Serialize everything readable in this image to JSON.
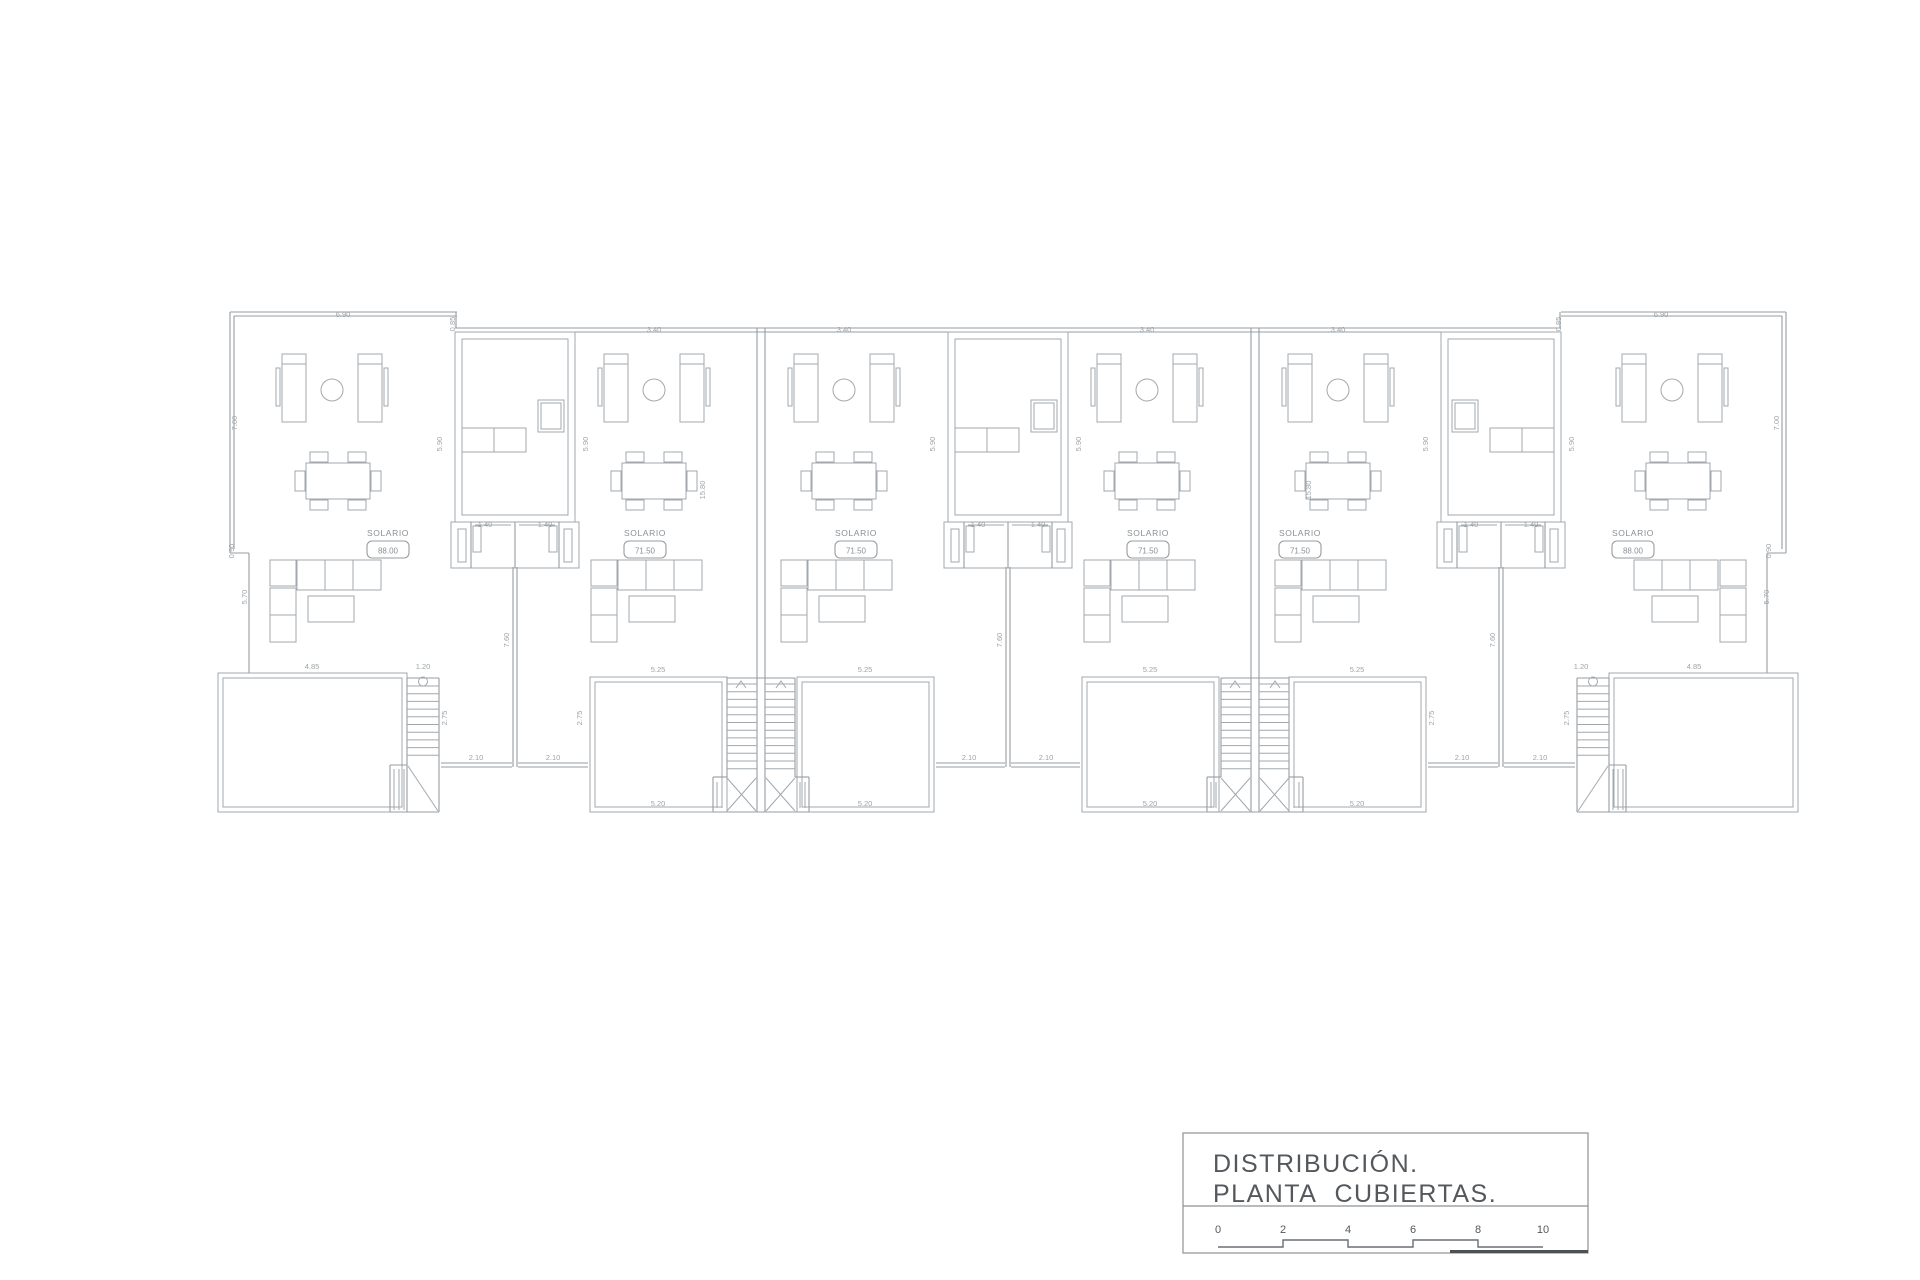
{
  "document": {
    "background": "#ffffff",
    "line_color": "#979da2",
    "furniture_line_color": "#a2a8ad",
    "dimension_text_color": "#9ea4a8",
    "title_text_color": "#54585c"
  },
  "title_block": {
    "line1": "DISTRIBUCIÓN.",
    "line2": "PLANTA CUBIERTAS.",
    "scale_numbers": [
      "0",
      "2",
      "4",
      "6",
      "8",
      "10"
    ]
  },
  "units": [
    {
      "label": "SOLARIO",
      "area": "88.00",
      "x": 388,
      "y": 536
    },
    {
      "label": "SOLARIO",
      "area": "71.50",
      "x": 645,
      "y": 536
    },
    {
      "label": "SOLARIO",
      "area": "71.50",
      "x": 856,
      "y": 536
    },
    {
      "label": "SOLARIO",
      "area": "71.50",
      "x": 1148,
      "y": 536
    },
    {
      "label": "SOLARIO",
      "area": "71.50",
      "x": 1300,
      "y": 536
    },
    {
      "label": "SOLARIO",
      "area": "88.00",
      "x": 1633,
      "y": 536
    }
  ],
  "dimensions": [
    {
      "t": "6.90",
      "x": 343,
      "y": 317,
      "r": 0
    },
    {
      "t": "6.90",
      "x": 1661,
      "y": 317,
      "r": 0
    },
    {
      "t": "3.40",
      "x": 654,
      "y": 332,
      "r": 0
    },
    {
      "t": "3.40",
      "x": 844,
      "y": 332,
      "r": 0
    },
    {
      "t": "3.40",
      "x": 1147,
      "y": 332,
      "r": 0
    },
    {
      "t": "3.40",
      "x": 1338,
      "y": 332,
      "r": 0
    },
    {
      "t": "0.85",
      "x": 455,
      "y": 324,
      "r": 1
    },
    {
      "t": "0.85",
      "x": 1561,
      "y": 324,
      "r": 1
    },
    {
      "t": "7.00",
      "x": 237,
      "y": 423,
      "r": 1
    },
    {
      "t": "7.00",
      "x": 1779,
      "y": 423,
      "r": 1
    },
    {
      "t": "5.90",
      "x": 442,
      "y": 444,
      "r": 1
    },
    {
      "t": "5.90",
      "x": 588,
      "y": 444,
      "r": 1
    },
    {
      "t": "5.90",
      "x": 935,
      "y": 444,
      "r": 1
    },
    {
      "t": "5.90",
      "x": 1081,
      "y": 444,
      "r": 1
    },
    {
      "t": "5.90",
      "x": 1428,
      "y": 444,
      "r": 1
    },
    {
      "t": "5.90",
      "x": 1574,
      "y": 444,
      "r": 1
    },
    {
      "t": "1.40",
      "x": 485,
      "y": 527,
      "r": 0
    },
    {
      "t": "1.40",
      "x": 545,
      "y": 527,
      "r": 0
    },
    {
      "t": "1.40",
      "x": 978,
      "y": 527,
      "r": 0
    },
    {
      "t": "1.40",
      "x": 1038,
      "y": 527,
      "r": 0
    },
    {
      "t": "1.40",
      "x": 1471,
      "y": 527,
      "r": 0
    },
    {
      "t": "1.40",
      "x": 1531,
      "y": 527,
      "r": 0
    },
    {
      "t": "0.90",
      "x": 234,
      "y": 551,
      "r": 1
    },
    {
      "t": "0.90",
      "x": 1771,
      "y": 551,
      "r": 1
    },
    {
      "t": "5.70",
      "x": 247,
      "y": 597,
      "r": 1
    },
    {
      "t": "5.70",
      "x": 1769,
      "y": 597,
      "r": 1
    },
    {
      "t": "15.80",
      "x": 705,
      "y": 490,
      "r": 1
    },
    {
      "t": "15.80",
      "x": 1311,
      "y": 490,
      "r": 1
    },
    {
      "t": "7.60",
      "x": 509,
      "y": 640,
      "r": 1
    },
    {
      "t": "7.60",
      "x": 1002,
      "y": 640,
      "r": 1
    },
    {
      "t": "7.60",
      "x": 1495,
      "y": 640,
      "r": 1
    },
    {
      "t": "4.85",
      "x": 312,
      "y": 669,
      "r": 0
    },
    {
      "t": "4.85",
      "x": 1694,
      "y": 669,
      "r": 0
    },
    {
      "t": "1.20",
      "x": 423,
      "y": 669,
      "r": 0
    },
    {
      "t": "1.20",
      "x": 1581,
      "y": 669,
      "r": 0
    },
    {
      "t": "5.25",
      "x": 658,
      "y": 672,
      "r": 0
    },
    {
      "t": "5.25",
      "x": 865,
      "y": 672,
      "r": 0
    },
    {
      "t": "5.25",
      "x": 1150,
      "y": 672,
      "r": 0
    },
    {
      "t": "5.25",
      "x": 1357,
      "y": 672,
      "r": 0
    },
    {
      "t": "2.75",
      "x": 447,
      "y": 718,
      "r": 1
    },
    {
      "t": "2.75",
      "x": 582,
      "y": 718,
      "r": 1
    },
    {
      "t": "2.75",
      "x": 1434,
      "y": 718,
      "r": 1
    },
    {
      "t": "2.75",
      "x": 1569,
      "y": 718,
      "r": 1
    },
    {
      "t": "2.10",
      "x": 476,
      "y": 760,
      "r": 0
    },
    {
      "t": "2.10",
      "x": 553,
      "y": 760,
      "r": 0
    },
    {
      "t": "2.10",
      "x": 969,
      "y": 760,
      "r": 0
    },
    {
      "t": "2.10",
      "x": 1046,
      "y": 760,
      "r": 0
    },
    {
      "t": "2.10",
      "x": 1462,
      "y": 760,
      "r": 0
    },
    {
      "t": "2.10",
      "x": 1540,
      "y": 760,
      "r": 0
    },
    {
      "t": "5.20",
      "x": 658,
      "y": 806,
      "r": 0
    },
    {
      "t": "5.20",
      "x": 865,
      "y": 806,
      "r": 0
    },
    {
      "t": "5.20",
      "x": 1150,
      "y": 806,
      "r": 0
    },
    {
      "t": "5.20",
      "x": 1357,
      "y": 806,
      "r": 0
    }
  ]
}
